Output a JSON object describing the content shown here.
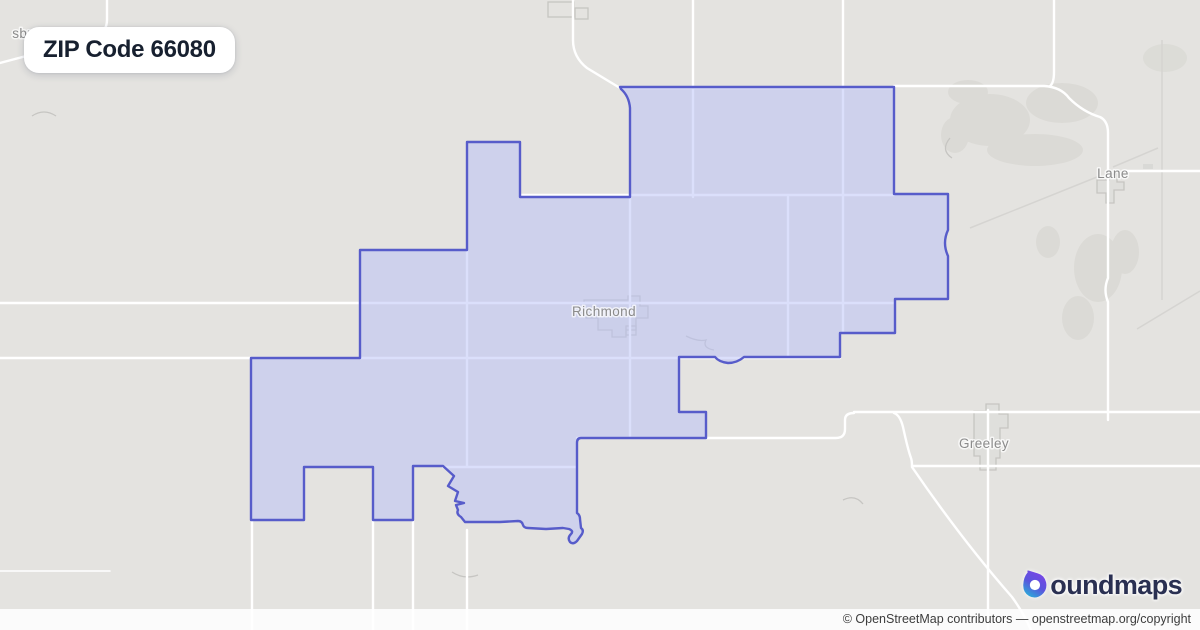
{
  "badge": {
    "label": "ZIP Code 66080"
  },
  "map": {
    "labels": {
      "partial_city_top_left": "sburg",
      "richmond": "Richmond",
      "lane": "Lane",
      "greeley": "Greeley"
    },
    "colors": {
      "background": "#e4e3e0",
      "road": "#ffffff",
      "boundary_stroke": "#575cca",
      "boundary_fill": "rgba(183,191,248,0.5)",
      "town_outline": "#c6c5c1",
      "label_text": "#8b8b8b"
    }
  },
  "branding": {
    "logo_text": "boundmaps",
    "logo_text_rest": "oundmaps",
    "logo_purple": "#7b45e6",
    "logo_teal": "#25b6d8",
    "logo_text_color": "#2a3052"
  },
  "attribution": {
    "prefix": "© OpenStreetMap contributors — ",
    "link": "openstreetmap.org/copyright"
  }
}
